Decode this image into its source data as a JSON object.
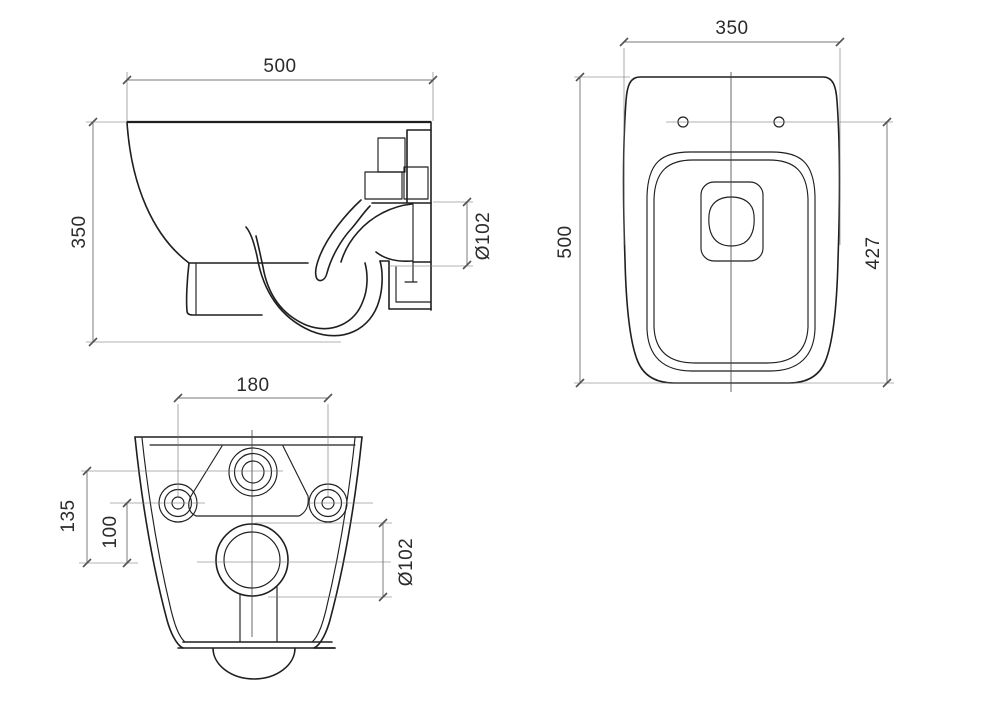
{
  "drawing": {
    "kind": "technical-dimension-drawing",
    "subject": "wall-hung-toilet",
    "colors": {
      "outline": "#1f1f1f",
      "dimension_line": "#777777",
      "extension_line": "#999999",
      "centerline": "#3a3a3a",
      "text": "#2b2b2b",
      "background": "#ffffff"
    },
    "views": {
      "side": {
        "dims": {
          "width": "500",
          "height": "350",
          "outlet_diameter": "Ø102"
        }
      },
      "top": {
        "dims": {
          "width": "350",
          "depth": "500",
          "hinge_to_front": "427"
        }
      },
      "rear": {
        "dims": {
          "bolt_spacing": "180",
          "inlet_drop": "135",
          "bolt_drop": "100",
          "outlet_diameter": "Ø102"
        }
      }
    }
  }
}
